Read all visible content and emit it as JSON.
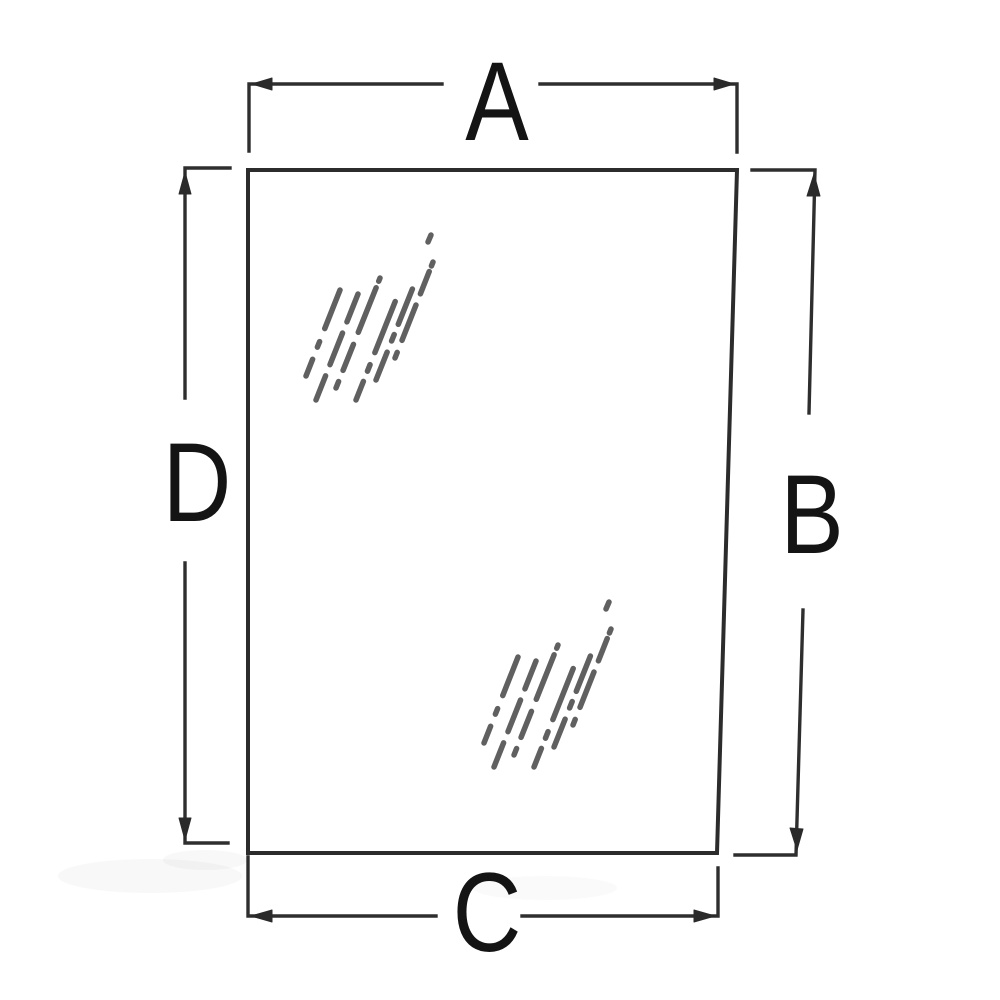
{
  "diagram": {
    "type": "technical-dimension-diagram",
    "subject": "glass-pane",
    "background_color": "#ffffff",
    "line_color": "#2c2c2c",
    "label_color": "#141414",
    "labels": {
      "top": "A",
      "right": "B",
      "bottom": "C",
      "left": "D"
    }
  }
}
